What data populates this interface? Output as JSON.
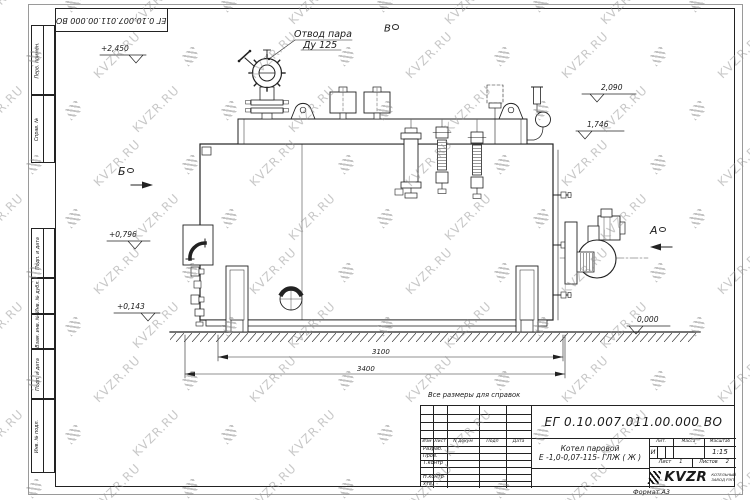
{
  "watermark": {
    "text": "KVZR.RU"
  },
  "corner_stamp": {
    "text": "ЕГ 0.10.007.011.00.000  ВО"
  },
  "side_stamps": [
    {
      "label": "Перв. примен."
    },
    {
      "label": "Справ. №"
    },
    {
      "label": "Подп. и дата"
    },
    {
      "label": "Инв. № дубл."
    },
    {
      "label": "Взам. инв. №"
    },
    {
      "label": "Подп. и дата"
    },
    {
      "label": "Инв. № подл."
    }
  ],
  "drawing": {
    "leader_note": {
      "line1": "Отвод пара",
      "line2": "Ду 125"
    },
    "view_markers": {
      "a": "А",
      "b": "Б",
      "v": "В"
    },
    "elevations": {
      "e2450": "+2,450",
      "e2090": "2,090",
      "e1746": "1,746",
      "e0796": "+0,796",
      "e0143": "+0,143",
      "e0000": "0,000"
    },
    "dimensions": {
      "d3100": "3100",
      "d3400": "3400"
    },
    "note": "Все размеры для справок"
  },
  "title_block": {
    "designation": "ЕГ 0.10.007.011.00.000  ВО",
    "name_line1": "Котел паровой",
    "name_line2": "Е -1,0-0,07-115- ГЛЖ ( Ж )",
    "headers": {
      "izm": "Изм",
      "list": "Лист",
      "ndokum": "N докум",
      "podp": "Подп",
      "data": "Дата"
    },
    "rows": {
      "razrab": "Разраб.",
      "prov": "Пров.",
      "tkontr": "Т.контр",
      "nkontr": "Н.контр",
      "utv": "Утв."
    },
    "lit_header": "Лит.",
    "mass_header": "Масса",
    "scale_header": "Масштаб",
    "lit_value": "И",
    "scale_value": "1:15",
    "sheet_label": "Лист",
    "sheet_value": "1",
    "sheets_label": "Листов",
    "sheets_value": "2",
    "logo": {
      "brand": "KVZR",
      "sub1": "КОТЕЛЬНЫЙ",
      "sub2": "ЗАВОД РЭП"
    },
    "format_label": "Формат А3"
  }
}
